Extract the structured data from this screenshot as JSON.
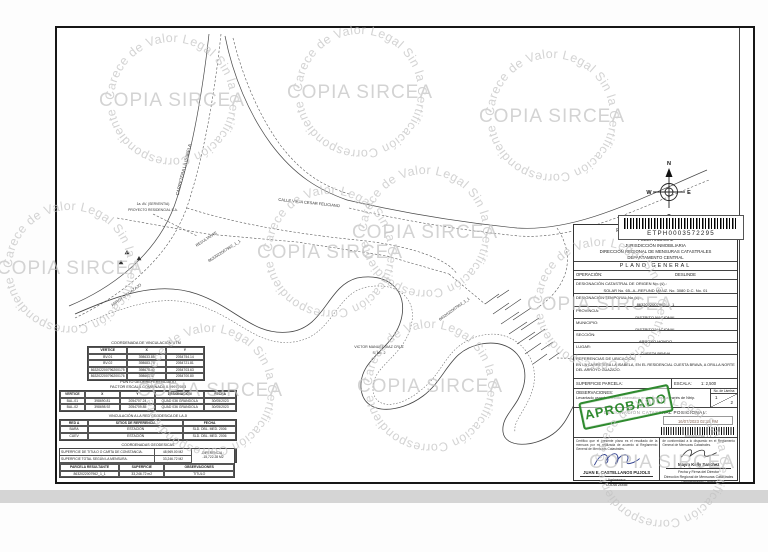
{
  "watermark": {
    "ring_text": "Carece de Valor Legal Sin la Certificación Correspondiente",
    "center_text": "COPIA SIRCEA",
    "color": "#c3c3c3",
    "positions": [
      {
        "x": 172,
        "y": 100
      },
      {
        "x": 360,
        "y": 92
      },
      {
        "x": 552,
        "y": 116
      },
      {
        "x": 70,
        "y": 268
      },
      {
        "x": 330,
        "y": 252
      },
      {
        "x": 425,
        "y": 232
      },
      {
        "x": 600,
        "y": 304
      },
      {
        "x": 210,
        "y": 390
      },
      {
        "x": 430,
        "y": 386
      },
      {
        "x": 662,
        "y": 462
      }
    ]
  },
  "compass": {
    "n": "N",
    "e": "E",
    "s": "S",
    "w": "W"
  },
  "map": {
    "labels": [
      {
        "text": "CARRETERA LA ISABELA",
        "x": 128,
        "y": 142,
        "rot": -76,
        "size": 4.4
      },
      {
        "text": "CALLE VIEJA CESAR FELICIANO",
        "x": 252,
        "y": 176,
        "rot": 6,
        "size": 4
      },
      {
        "text": "1a. AV. (SERVENTIA)",
        "x": 96,
        "y": 177,
        "rot": 0,
        "size": 3.4
      },
      {
        "text": "PROYECTO RESIDENCIAL S.A.",
        "x": 96,
        "y": 183,
        "rot": 0,
        "size": 3.4
      },
      {
        "text": "RESULTANTE",
        "x": 150,
        "y": 212,
        "rot": -33,
        "size": 3.8
      },
      {
        "text": "8632022007962_1_1",
        "x": 168,
        "y": 224,
        "rot": -33,
        "size": 4
      },
      {
        "text": "ARROYO GUAZAJO",
        "x": 70,
        "y": 268,
        "rot": -36,
        "size": 3.9
      },
      {
        "text": "VICTOR MANUEL DIAZ CRUZ",
        "x": 322,
        "y": 320,
        "rot": 0,
        "size": 3.6
      },
      {
        "text": "S. No. 2",
        "x": 322,
        "y": 326,
        "rot": 0,
        "size": 3.6
      },
      {
        "text": "8632022007962_1_1",
        "x": 398,
        "y": 282,
        "rot": -36,
        "size": 3.9
      },
      {
        "text": "RESULTANTE",
        "x": 592,
        "y": 332,
        "rot": 0,
        "size": 3.4
      }
    ]
  },
  "barcode": {
    "number": "ETPH0003572295"
  },
  "title_block": {
    "republic": "REPÚBLICA DOMINICANA",
    "poder": "PODER JUDICIAL",
    "jurisdiccion": "JURISDICCIÓN INMOBILIARIA",
    "direccion": "DIRECCIÓN REGIONAL DE MENSURAS CATASTRALES",
    "departamento": "DEPARTAMENTO CENTRAL",
    "plano": "PLANO GENERAL",
    "operacion_label": "OPERACIÓN:",
    "operacion": "DESLINDE",
    "origen_label": "DESIGNACIÓN CATASTRAL DE ORIGEN No. (s).:",
    "origen": "SOLAR No. 65--A--REFUND MANZ. No. 3080 D.C. No. 01",
    "temporal_label": "DESIGNACIÓN TEMPORAL No (s).:",
    "temporal": "8632022007962_1_1",
    "provincia_label": "PROVINCIA:",
    "provincia": "DISTRITO NACIONAL",
    "municipio_label": "MUNICIPIO:",
    "municipio": "DISTRITO NACIONAL",
    "seccion_label": "SECCIÓN:",
    "seccion": "ARROYO HONDO",
    "lugar_label": "LUGAR:",
    "lugar": "CUESTA BRAVA",
    "referencias_label": "REFERENCIAS DE UBICACIÓN:",
    "referencias": "EN LA CARRETERA LA ISABELA, EN EL RESIDENCIAL CUESTA BRAVA, A ORILLA NORTE DEL ARROYO GUAZAJO.",
    "superficie_label": "SUPERFICIE PARCELA:",
    "escala_label": "ESCALA:",
    "escala": "1: 2,500",
    "observaciones_label": "OBSERVACIONES:",
    "observaciones": "Levantado usando método cinemático en tiempo real a través de Ntrip.",
    "lamina_label": "No. de Lámina",
    "lamina_1": "1",
    "lamina_2": "2",
    "posicional_label": "DESIGNACIÓN CATASTRAL POSICIONAL:"
  },
  "approval": {
    "stamp": "APROBADO",
    "date": "16/07/2023 02:18 PM",
    "barcode_caption": "8632022007962_1_1"
  },
  "signatures": {
    "left_cert": "Certifico que el presente plano es el resultado de la mensura por mí realizada de acuerdo al Reglamento General de Mensuras Catastrales.",
    "right_cert": "de conformidad a lo dispuesto en el Reglamento General de Mensuras Catastrales.",
    "surveyor_name": "JUAN E. CASTELLANOS PUJOLS",
    "surveyor_title": "Agrimensor",
    "surveyor_codia": "CODIA 24455",
    "director_name": "Mayra Kelly Sanchez",
    "director_line1": "Fecha y Firma del Director",
    "director_line2": "Dirección Regional de Mensuras Catastrales",
    "director_line3": "Departamento Central"
  },
  "tables": {
    "utm": {
      "title": "COORDENADA DE VINCULACIÓN UTM",
      "cols": [
        "34fr",
        "33fr",
        "33fr"
      ],
      "header": [
        "VERTICE",
        "X",
        "Y"
      ],
      "rows": [
        [
          "BV-01",
          "398633.85",
          "2054754.14"
        ],
        [
          "BV-02",
          "398683.74",
          "2054721.81"
        ],
        [
          "863202200796200175",
          "398675.40",
          "2054703.63"
        ],
        [
          "863202200796200176",
          "398661.47",
          "2054700.80"
        ]
      ]
    },
    "georef": {
      "title1": "PUNTO GEORREFERENCIADO",
      "title2": "FACTOR ESCALA COMBINADA 0.99972003",
      "cols": [
        "14fr",
        "20fr",
        "20fr",
        "28fr",
        "18fr"
      ],
      "header": [
        "VERTICE",
        "X",
        "Y",
        "DESIGNACIÓN",
        "FECHA"
      ],
      "rows": [
        [
          "BAL-01",
          "398690.81",
          "2054707.24",
          "QUAD 036 GRANDOLA",
          "30/05/2023"
        ],
        [
          "BAL-02",
          "398698.92",
          "2054709.85",
          "QUAD 036 GRANDOLA",
          "30/05/2023"
        ]
      ]
    },
    "vinculacion_band": "VINCULACIÓN A LA RED GEODESICA DE LA JI",
    "referencia": {
      "cols": [
        "16fr",
        "54fr",
        "30fr"
      ],
      "header": [
        "RED A",
        "SITIOS DE REFERENCIA",
        "FECHA"
      ],
      "rows": [
        [
          "BARA",
          "ESTACIÓN",
          "SLD. DBL. MED. 2006"
        ],
        [
          "CUEV",
          "ESTACIÓN",
          "SLD. DBL. MED. 2006"
        ]
      ]
    },
    "geodesicas_band": "COORDENADAS GEODESICAS",
    "geodesicas": {
      "cols": [
        "20fr",
        "24fr",
        "24fr",
        "18fr",
        "14fr"
      ],
      "header": [
        "PUNTO VINCULADO",
        "LATITUD",
        "LONGITUD",
        "VINCULACIÓN A LA RED",
        "FECHA"
      ],
      "rows": [
        [
          "7086",
          "18°27'18.867\"N",
          "69°59'53.468\"W",
          "RED 4",
          "29/01/2018"
        ]
      ]
    },
    "areas": {
      "titulo_label": "SUPERFICIE DE TITULO O CARTA DE CONSTANCIA.",
      "titulo_value": "48,969.00 M2",
      "mensura_label": "SUPERFICIE TOTAL SEGÚN LA MENSURA.",
      "mensura_value": "33,246.72 M2",
      "diferencia_label": "DIFERENCIA :",
      "diferencia_value": "-15,722.28 M2"
    },
    "areas_bottom": {
      "cols": [
        "34fr",
        "26fr",
        "40fr"
      ],
      "header": [
        "PARCELA RESULTANTE",
        "SUPERFICIE",
        "OBSERVACIONES"
      ],
      "rows": [
        [
          "8632022007962_1_1",
          "33,246.72 m2",
          "TITULO"
        ]
      ]
    }
  }
}
